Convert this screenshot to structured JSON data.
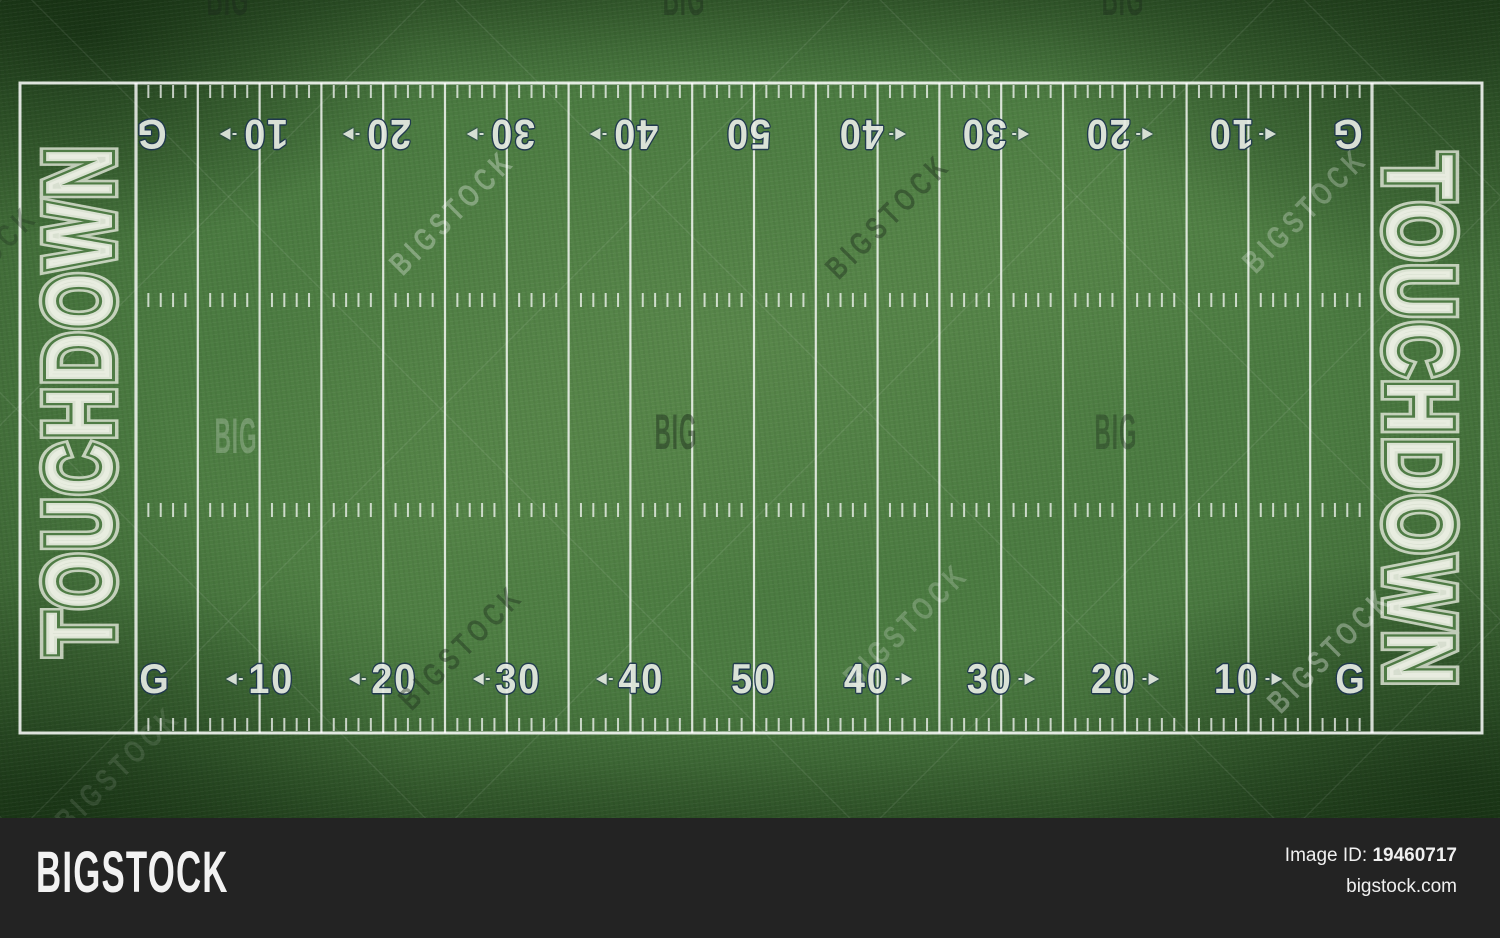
{
  "field": {
    "endzone_left_text": "TOUCHDOWN",
    "endzone_right_text": "TOUCHDOWN",
    "yard_numbers": [
      {
        "label": "G",
        "arrow": null
      },
      {
        "label": "10",
        "arrow": "left"
      },
      {
        "label": "20",
        "arrow": "left"
      },
      {
        "label": "30",
        "arrow": "left"
      },
      {
        "label": "40",
        "arrow": "left"
      },
      {
        "label": "50",
        "arrow": null
      },
      {
        "label": "40",
        "arrow": "right"
      },
      {
        "label": "30",
        "arrow": "right"
      },
      {
        "label": "20",
        "arrow": "right"
      },
      {
        "label": "10",
        "arrow": "right"
      },
      {
        "label": "G",
        "arrow": null
      }
    ],
    "colors": {
      "grass": "#4b7b41",
      "line": "#ffffff",
      "number_fill": "#e6ebe4",
      "number_outline": "#1e3550",
      "endzone_letter": "#eef1e6"
    }
  },
  "watermarks": {
    "light_color": "#ffffff",
    "dark_color": "#1c2b1c",
    "instances": [
      {
        "text": "BIGSTOCK",
        "x": 452,
        "y": 212,
        "angle": -45,
        "tone": "light",
        "opacity": 0.3
      },
      {
        "text": "BIGSTOCK",
        "x": 888,
        "y": 216,
        "angle": -45,
        "tone": "dark",
        "opacity": 0.42
      },
      {
        "text": "BIGSTOCK",
        "x": 1305,
        "y": 210,
        "angle": -45,
        "tone": "light",
        "opacity": 0.26
      },
      {
        "text": "BIGSTOCK",
        "x": -25,
        "y": 268,
        "angle": -45,
        "tone": "dark",
        "opacity": 0.3
      },
      {
        "text": "BIGSTOCK",
        "x": 461,
        "y": 647,
        "angle": -45,
        "tone": "dark",
        "opacity": 0.4
      },
      {
        "text": "BIGSTOCK",
        "x": 906,
        "y": 625,
        "angle": -45,
        "tone": "light",
        "opacity": 0.2
      },
      {
        "text": "BIGSTOCK",
        "x": 1330,
        "y": 650,
        "angle": -45,
        "tone": "light",
        "opacity": 0.32
      },
      {
        "text": "BIGSTOCK",
        "x": 118,
        "y": 768,
        "angle": -45,
        "tone": "light",
        "opacity": 0.1
      },
      {
        "text": "BIG",
        "x": 236,
        "y": 436,
        "angle": 0,
        "tone": "light",
        "opacity": 0.22
      },
      {
        "text": "BIG",
        "x": 676,
        "y": 432,
        "angle": 0,
        "tone": "dark",
        "opacity": 0.45
      },
      {
        "text": "BIG",
        "x": 1116,
        "y": 432,
        "angle": 0,
        "tone": "dark",
        "opacity": 0.36
      },
      {
        "text": "BIG",
        "x": 228,
        "y": -2,
        "angle": 0,
        "tone": "dark",
        "opacity": 0.45
      },
      {
        "text": "BIG",
        "x": 684,
        "y": -2,
        "angle": 0,
        "tone": "dark",
        "opacity": 0.4
      },
      {
        "text": "BIG",
        "x": 1123,
        "y": -2,
        "angle": 0,
        "tone": "dark",
        "opacity": 0.4
      }
    ]
  },
  "footer": {
    "logo_text": "BIGSTOCK",
    "image_id_label": "Image ID:",
    "image_id": "19460717",
    "site_url": "bigstock.com",
    "bg_color": "#232323"
  }
}
